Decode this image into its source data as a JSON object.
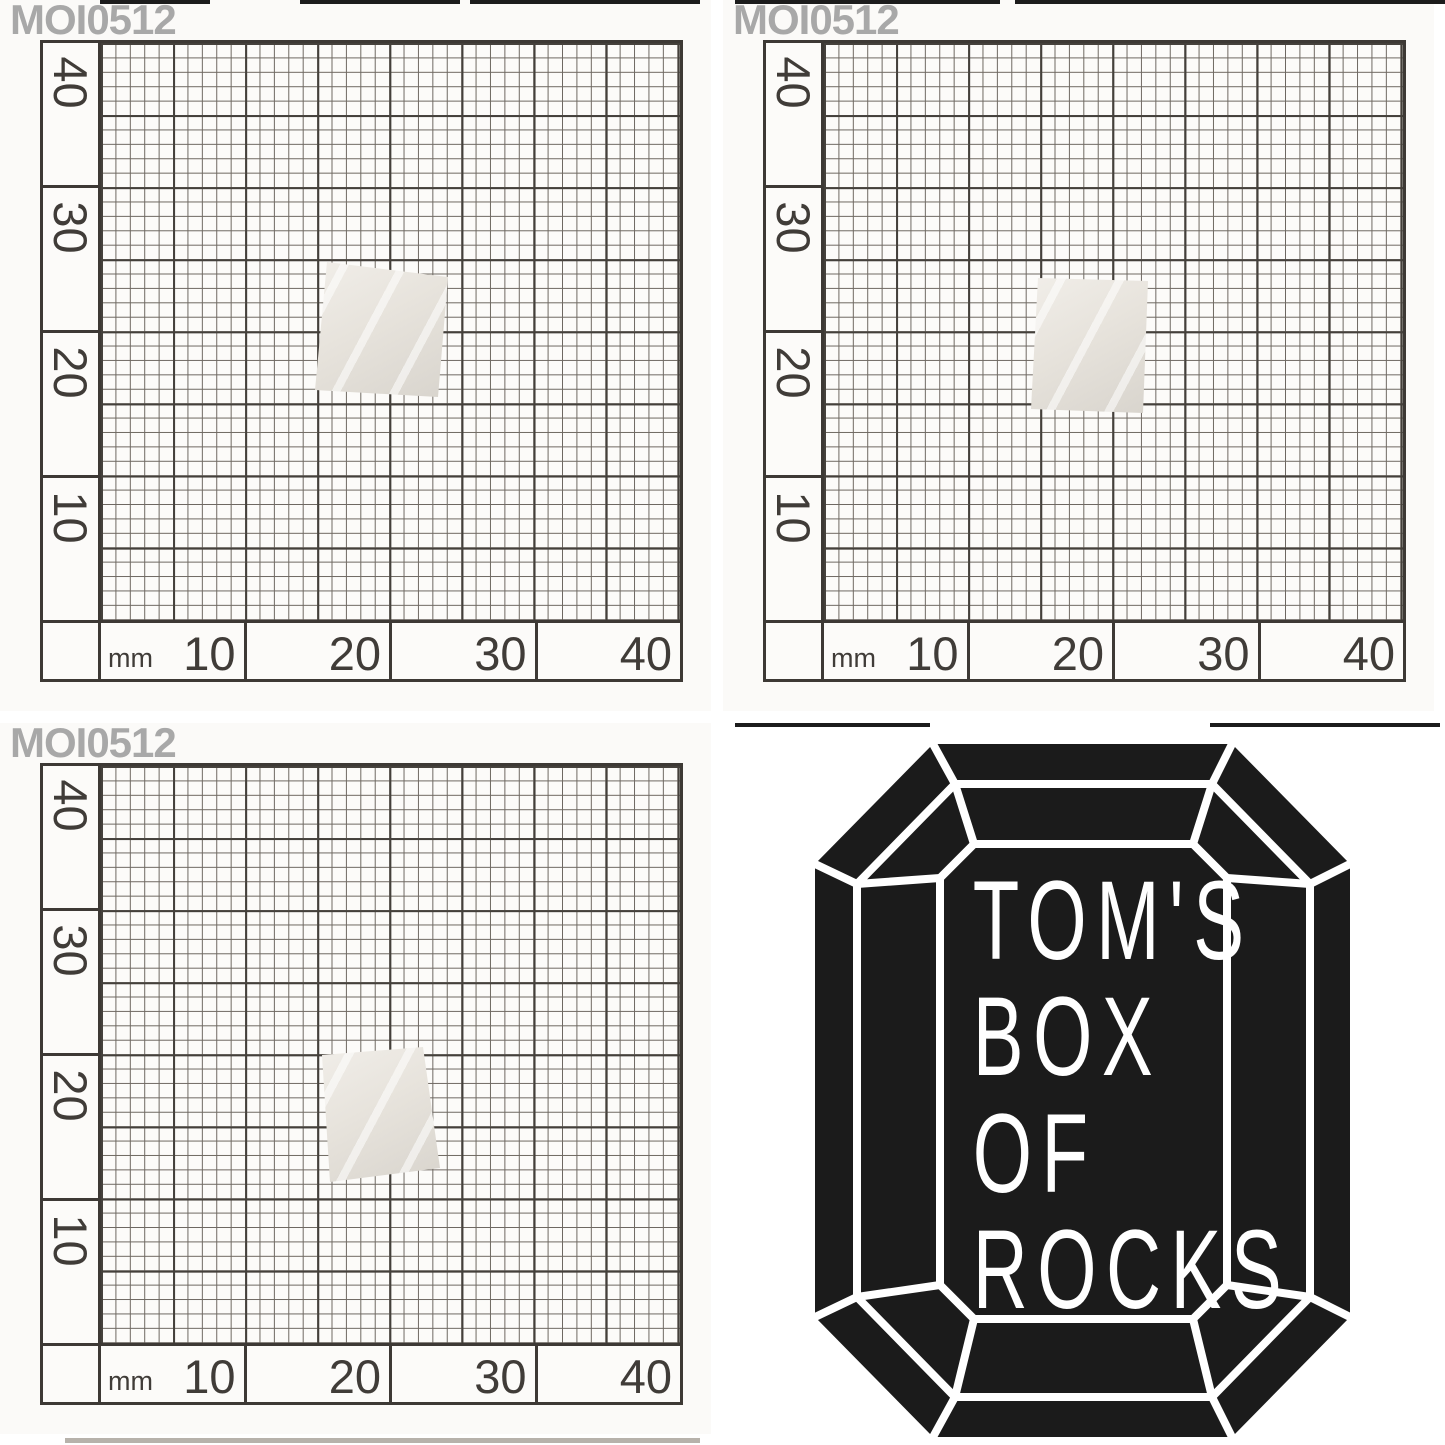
{
  "specimen_id": "MOI0512",
  "panels": [
    {
      "label": "MOI0512",
      "view": "photo-front"
    },
    {
      "label": "MOI0512",
      "view": "photo-side"
    },
    {
      "label": "MOI0512",
      "view": "photo-back"
    },
    {
      "view": "shop-logo"
    }
  ],
  "graph_paper": {
    "unit_label": "mm",
    "x_axis_ticks": [
      "10",
      "20",
      "30",
      "40"
    ],
    "y_axis_ticks": [
      "40",
      "30",
      "20",
      "10"
    ],
    "minor_square_mm": 1,
    "major_square_mm": 5,
    "major_line_color": "#44403b",
    "minor_line_color": "#6e6861"
  },
  "label_color": "#a8a8a8",
  "specimen_colors": {
    "light": "#f1eee9",
    "dark": "#d8d4cd"
  },
  "logo": {
    "lines": [
      "TOM'S",
      "BOX",
      "OF",
      "ROCKS"
    ],
    "shape": "emerald-cut-gem",
    "fill_color": "#1b1b1b",
    "line_color": "#ffffff"
  }
}
